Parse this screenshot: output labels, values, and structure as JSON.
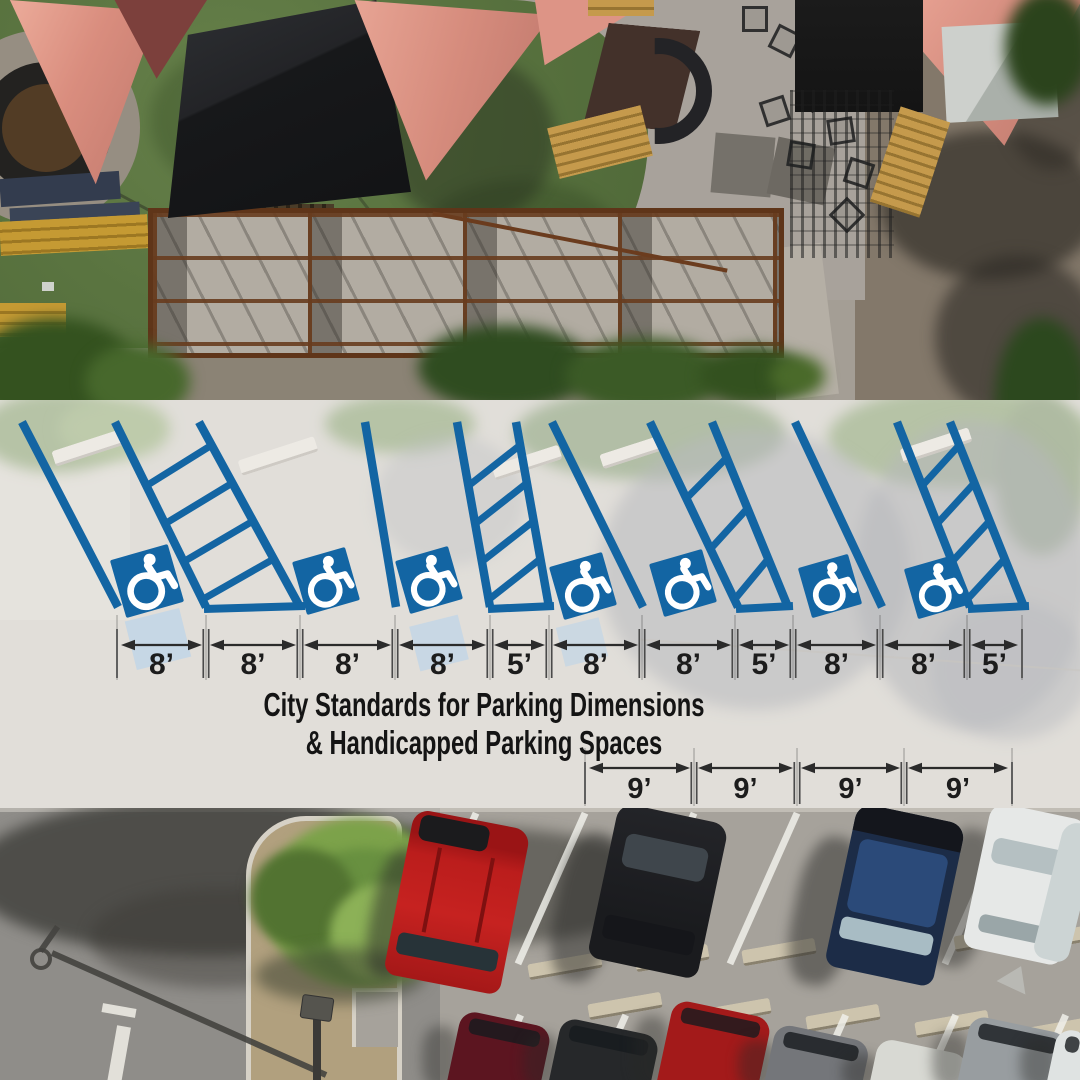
{
  "title": {
    "line1": "City Standards for Parking Dimensions",
    "line2": "& Handicapped Parking Spaces"
  },
  "colors": {
    "stripe_blue": "#1365a3",
    "symbol_blue": "#1365a3",
    "symbol_glyph": "#ffffff",
    "dim_text": "#1c1c1c",
    "dim_line": "#2b2b2b",
    "tick": "#4a4a4a",
    "title_text": "#141414"
  },
  "diagram": {
    "stripe_top_y": 422,
    "stripe_bottom_y": 607,
    "lines": [
      {
        "xt": 22,
        "xb": 118
      },
      {
        "xt": 115,
        "xb": 206
      },
      {
        "xt": 199,
        "xb": 300
      },
      {
        "xt": 365,
        "xb": 396
      },
      {
        "xt": 457,
        "xb": 490
      },
      {
        "xt": 516,
        "xb": 549
      },
      {
        "xt": 552,
        "xb": 643
      },
      {
        "xt": 650,
        "xb": 738
      },
      {
        "xt": 712,
        "xb": 788
      },
      {
        "xt": 795,
        "xb": 882
      },
      {
        "xt": 897,
        "xb": 970
      },
      {
        "xt": 950,
        "xb": 1024
      }
    ],
    "ladders": [
      {
        "left": 1,
        "right": 2,
        "rungs": 4
      },
      {
        "left": 4,
        "right": 5,
        "rungs": 4
      },
      {
        "left": 7,
        "right": 8,
        "rungs": 3
      },
      {
        "left": 10,
        "right": 11,
        "rungs": 4
      }
    ],
    "symbols": [
      {
        "x": 147,
        "y": 581,
        "size": 60
      },
      {
        "x": 326,
        "y": 581,
        "size": 55
      },
      {
        "x": 429,
        "y": 580,
        "size": 55
      },
      {
        "x": 583,
        "y": 586,
        "size": 55
      },
      {
        "x": 683,
        "y": 583,
        "size": 55
      },
      {
        "x": 830,
        "y": 586,
        "size": 52
      },
      {
        "x": 936,
        "y": 587,
        "size": 52
      }
    ],
    "symbol_tilt": -16,
    "dim_rows": [
      {
        "arrow_y": 645,
        "label_y": 674,
        "tick_top": 629,
        "tick_bottom": 678,
        "font_size": 30,
        "boundaries": [
          117,
          206,
          300,
          395,
          490,
          549,
          642,
          735,
          793,
          880,
          967,
          1022
        ],
        "labels": [
          "8’",
          "8’",
          "8’",
          "8’",
          "5’",
          "8’",
          "8’",
          "5’",
          "8’",
          "8’",
          "5’"
        ]
      },
      {
        "arrow_y": 768,
        "label_y": 798,
        "tick_top": 762,
        "tick_bottom": 804,
        "font_size": 29,
        "boundaries": [
          585,
          694,
          797,
          904,
          1012
        ],
        "labels": [
          "9’",
          "9’",
          "9’",
          "9’"
        ]
      }
    ]
  }
}
